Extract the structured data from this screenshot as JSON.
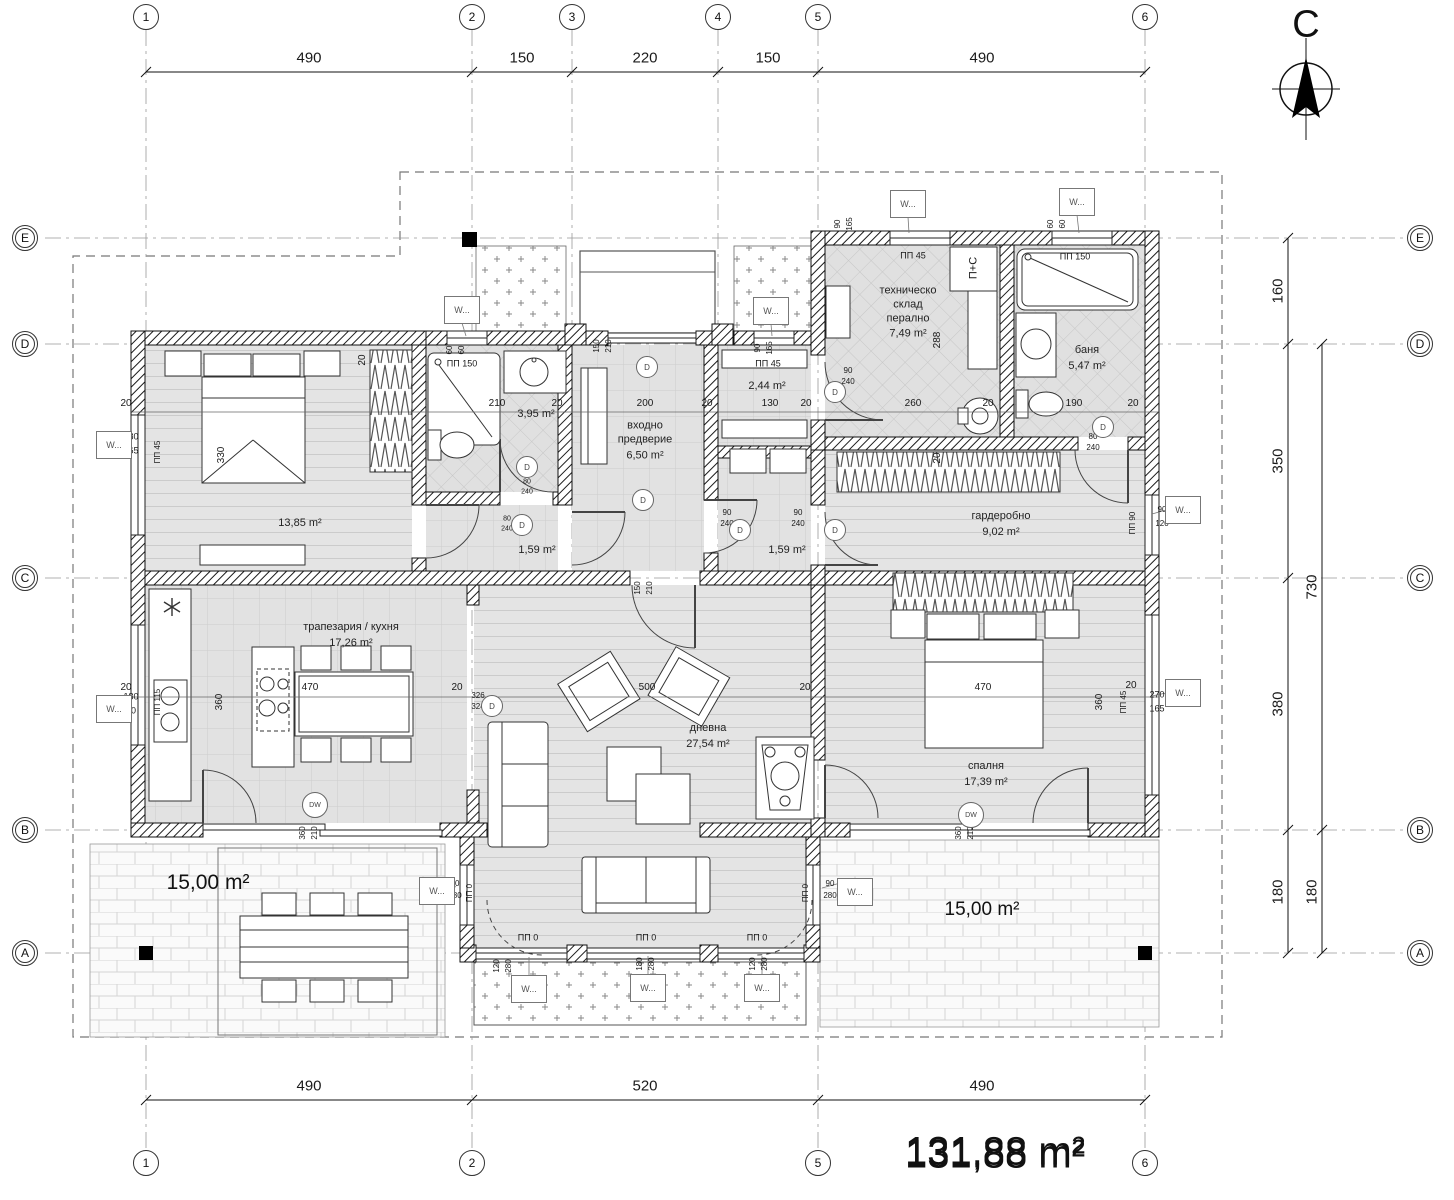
{
  "meta": {
    "north_label": "С",
    "total_area": "131,88 m²"
  },
  "grid": {
    "cols": [
      {
        "label": "1",
        "x": 146,
        "bottom": true
      },
      {
        "label": "2",
        "x": 472,
        "bottom": true
      },
      {
        "label": "3",
        "x": 572,
        "bottom": false
      },
      {
        "label": "4",
        "x": 718,
        "bottom": false
      },
      {
        "label": "5",
        "x": 818,
        "bottom": true
      },
      {
        "label": "6",
        "x": 1145,
        "bottom": true
      }
    ],
    "rows": [
      {
        "label": "E",
        "y": 238
      },
      {
        "label": "D",
        "y": 344
      },
      {
        "label": "C",
        "y": 578
      },
      {
        "label": "B",
        "y": 830
      },
      {
        "label": "A",
        "y": 953
      }
    ]
  },
  "dim_chains": {
    "top": [
      {
        "t": "490",
        "x": 309
      },
      {
        "t": "150",
        "x": 522
      },
      {
        "t": "220",
        "x": 645
      },
      {
        "t": "150",
        "x": 768
      },
      {
        "t": "490",
        "x": 982
      }
    ],
    "bottom": [
      {
        "t": "490",
        "x": 309
      },
      {
        "t": "520",
        "x": 645
      },
      {
        "t": "490",
        "x": 982
      }
    ],
    "right1": [
      {
        "t": "160",
        "y": 291
      },
      {
        "t": "350",
        "y": 461
      },
      {
        "t": "380",
        "y": 704
      },
      {
        "t": "180",
        "y": 892
      }
    ],
    "right2": [
      {
        "t": "730",
        "y": 587
      },
      {
        "t": "180",
        "y": 892
      }
    ]
  },
  "rooms": [
    {
      "name": "",
      "area": "13,85 m²",
      "x": 300,
      "y": 522
    },
    {
      "name": "",
      "area": "3,95 m²",
      "x": 536,
      "y": 413
    },
    {
      "name": "входно\nпредверие",
      "area": "6,50 m²",
      "x": 645,
      "y": 440
    },
    {
      "name": "",
      "area": "2,44 m²",
      "x": 767,
      "y": 385
    },
    {
      "name": "техническо\nсклад\nперално",
      "area": "7,49 m²",
      "x": 908,
      "y": 312
    },
    {
      "name": "баня",
      "area": "5,47 m²",
      "x": 1087,
      "y": 358
    },
    {
      "name": "гардеробно",
      "area": "9,02 m²",
      "x": 1001,
      "y": 524
    },
    {
      "name": "",
      "area": "1,59 m²",
      "x": 537,
      "y": 549
    },
    {
      "name": "",
      "area": "1,59 m²",
      "x": 787,
      "y": 549
    },
    {
      "name": "трапезария / кухня",
      "area": "17,26 m²",
      "x": 351,
      "y": 635
    },
    {
      "name": "дневна",
      "area": "27,54 m²",
      "x": 708,
      "y": 736
    },
    {
      "name": "спалня",
      "area": "17,39 m²",
      "x": 986,
      "y": 774
    }
  ],
  "area_labels": [
    {
      "text": "15,00 m²",
      "x": 208,
      "y": 883,
      "size": 21
    },
    {
      "text": "15,00 m²",
      "x": 982,
      "y": 910,
      "size": 19
    },
    {
      "text": "131,88 m²",
      "x": 995,
      "y": 1155,
      "size": 40
    }
  ],
  "window_tags": [
    {
      "label": "W...",
      "x": 114,
      "y": 445
    },
    {
      "label": "W...",
      "x": 114,
      "y": 709
    },
    {
      "label": "W...",
      "x": 462,
      "y": 310
    },
    {
      "label": "W...",
      "x": 771,
      "y": 311
    },
    {
      "label": "W...",
      "x": 908,
      "y": 204
    },
    {
      "label": "W...",
      "x": 1077,
      "y": 202
    },
    {
      "label": "W...",
      "x": 1183,
      "y": 510
    },
    {
      "label": "W...",
      "x": 1183,
      "y": 693
    },
    {
      "label": "W...",
      "x": 437,
      "y": 891
    },
    {
      "label": "W...",
      "x": 855,
      "y": 892
    },
    {
      "label": "W...",
      "x": 529,
      "y": 989
    },
    {
      "label": "W...",
      "x": 648,
      "y": 988
    },
    {
      "label": "W...",
      "x": 762,
      "y": 988
    }
  ],
  "door_tags": [
    {
      "label": "D",
      "x": 527,
      "y": 467
    },
    {
      "label": "D",
      "x": 522,
      "y": 525
    },
    {
      "label": "D",
      "x": 647,
      "y": 367
    },
    {
      "label": "D",
      "x": 643,
      "y": 500
    },
    {
      "label": "D",
      "x": 492,
      "y": 706
    },
    {
      "label": "D",
      "x": 740,
      "y": 530
    },
    {
      "label": "D",
      "x": 835,
      "y": 530
    },
    {
      "label": "D",
      "x": 835,
      "y": 392
    },
    {
      "label": "D",
      "x": 1103,
      "y": 427
    },
    {
      "label": "DW",
      "x": 971,
      "y": 815
    },
    {
      "label": "DW",
      "x": 315,
      "y": 805
    }
  ],
  "annotations": [
    {
      "t": "20",
      "x": 126,
      "y": 404
    },
    {
      "t": "210",
      "x": 497,
      "y": 404
    },
    {
      "t": "20",
      "x": 557,
      "y": 404
    },
    {
      "t": "200",
      "x": 645,
      "y": 404
    },
    {
      "t": "20",
      "x": 707,
      "y": 404
    },
    {
      "t": "130",
      "x": 770,
      "y": 404
    },
    {
      "t": "20",
      "x": 806,
      "y": 404
    },
    {
      "t": "260",
      "x": 913,
      "y": 404
    },
    {
      "t": "20",
      "x": 988,
      "y": 404
    },
    {
      "t": "190",
      "x": 1074,
      "y": 404
    },
    {
      "t": "490",
      "x": 1103,
      "y": 428,
      "r": -90
    },
    {
      "t": "20",
      "x": 1133,
      "y": 404
    },
    {
      "t": "330",
      "x": 222,
      "y": 455,
      "r": -90
    },
    {
      "t": "20",
      "x": 363,
      "y": 360,
      "r": -90
    },
    {
      "t": "180",
      "x": 131,
      "y": 437,
      "s": 9
    },
    {
      "t": "165",
      "x": 131,
      "y": 451,
      "s": 9
    },
    {
      "t": "ПП 45",
      "x": 158,
      "y": 452,
      "r": -90,
      "s": 8
    },
    {
      "t": "180",
      "x": 131,
      "y": 697,
      "s": 9
    },
    {
      "t": "40",
      "x": 131,
      "y": 711,
      "s": 9
    },
    {
      "t": "ПП 115",
      "x": 158,
      "y": 702,
      "r": -90,
      "s": 8
    },
    {
      "t": "20",
      "x": 126,
      "y": 688
    },
    {
      "t": "360",
      "x": 220,
      "y": 702,
      "r": -90
    },
    {
      "t": "470",
      "x": 310,
      "y": 688
    },
    {
      "t": "20",
      "x": 457,
      "y": 688
    },
    {
      "t": "326",
      "x": 478,
      "y": 696,
      "s": 8
    },
    {
      "t": "324",
      "x": 478,
      "y": 707,
      "s": 8
    },
    {
      "t": "500",
      "x": 647,
      "y": 688
    },
    {
      "t": "20",
      "x": 805,
      "y": 688
    },
    {
      "t": "470",
      "x": 983,
      "y": 688
    },
    {
      "t": "360",
      "x": 1100,
      "y": 702,
      "r": -90
    },
    {
      "t": "20",
      "x": 1131,
      "y": 686
    },
    {
      "t": "270",
      "x": 1157,
      "y": 695,
      "s": 9
    },
    {
      "t": "165",
      "x": 1157,
      "y": 709,
      "s": 9
    },
    {
      "t": "ПП 45",
      "x": 1124,
      "y": 702,
      "r": -90,
      "s": 8
    },
    {
      "t": "288",
      "x": 938,
      "y": 340,
      "r": -90
    },
    {
      "t": "20",
      "x": 938,
      "y": 458,
      "r": -90
    },
    {
      "t": "90",
      "x": 838,
      "y": 224,
      "r": -90,
      "s": 8
    },
    {
      "t": "165",
      "x": 850,
      "y": 224,
      "r": -90,
      "s": 8
    },
    {
      "t": "ПП 45",
      "x": 913,
      "y": 256,
      "s": 9
    },
    {
      "t": "60",
      "x": 1051,
      "y": 224,
      "r": -90,
      "s": 8
    },
    {
      "t": "60",
      "x": 1063,
      "y": 224,
      "r": -90,
      "s": 8
    },
    {
      "t": "ПП 150",
      "x": 1075,
      "y": 257,
      "s": 9
    },
    {
      "t": "60",
      "x": 450,
      "y": 350,
      "r": -90,
      "s": 8
    },
    {
      "t": "60",
      "x": 462,
      "y": 350,
      "r": -90,
      "s": 8
    },
    {
      "t": "90",
      "x": 758,
      "y": 348,
      "r": -90,
      "s": 8
    },
    {
      "t": "165",
      "x": 770,
      "y": 348,
      "r": -90,
      "s": 8
    },
    {
      "t": "ПП 45",
      "x": 768,
      "y": 364,
      "s": 9
    },
    {
      "t": "ПП 150",
      "x": 462,
      "y": 364,
      "s": 9
    },
    {
      "t": "150",
      "x": 597,
      "y": 346,
      "r": -90,
      "s": 8
    },
    {
      "t": "210",
      "x": 609,
      "y": 346,
      "r": -90,
      "s": 8
    },
    {
      "t": "150",
      "x": 638,
      "y": 588,
      "r": -90,
      "s": 8
    },
    {
      "t": "210",
      "x": 650,
      "y": 588,
      "r": -90,
      "s": 8
    },
    {
      "t": "360",
      "x": 303,
      "y": 833,
      "r": -90,
      "s": 8
    },
    {
      "t": "210",
      "x": 315,
      "y": 833,
      "r": -90,
      "s": 8
    },
    {
      "t": "360",
      "x": 959,
      "y": 833,
      "r": -90,
      "s": 8
    },
    {
      "t": "210",
      "x": 971,
      "y": 833,
      "r": -90,
      "s": 8
    },
    {
      "t": "80",
      "x": 507,
      "y": 519,
      "s": 7
    },
    {
      "t": "240",
      "x": 507,
      "y": 529,
      "s": 7
    },
    {
      "t": "80",
      "x": 527,
      "y": 482,
      "s": 7
    },
    {
      "t": "240",
      "x": 527,
      "y": 492,
      "s": 7
    },
    {
      "t": "90",
      "x": 727,
      "y": 513,
      "s": 8
    },
    {
      "t": "240",
      "x": 727,
      "y": 524,
      "s": 8
    },
    {
      "t": "90",
      "x": 798,
      "y": 513,
      "s": 8
    },
    {
      "t": "240",
      "x": 798,
      "y": 524,
      "s": 8
    },
    {
      "t": "90",
      "x": 848,
      "y": 371,
      "s": 8
    },
    {
      "t": "240",
      "x": 848,
      "y": 382,
      "s": 8
    },
    {
      "t": "80",
      "x": 1093,
      "y": 437,
      "s": 8
    },
    {
      "t": "240",
      "x": 1093,
      "y": 448,
      "s": 8
    },
    {
      "t": "90",
      "x": 455,
      "y": 884,
      "s": 8
    },
    {
      "t": "280",
      "x": 455,
      "y": 896,
      "s": 8
    },
    {
      "t": "ПП 0",
      "x": 470,
      "y": 893,
      "r": -90,
      "s": 8
    },
    {
      "t": "90",
      "x": 830,
      "y": 884,
      "s": 8
    },
    {
      "t": "280",
      "x": 830,
      "y": 896,
      "s": 8
    },
    {
      "t": "ПП 0",
      "x": 806,
      "y": 893,
      "r": -90,
      "s": 8
    },
    {
      "t": "120",
      "x": 497,
      "y": 966,
      "r": -90,
      "s": 8
    },
    {
      "t": "280",
      "x": 509,
      "y": 966,
      "r": -90,
      "s": 8
    },
    {
      "t": "180",
      "x": 640,
      "y": 964,
      "r": -90,
      "s": 8
    },
    {
      "t": "280",
      "x": 652,
      "y": 964,
      "r": -90,
      "s": 8
    },
    {
      "t": "120",
      "x": 753,
      "y": 964,
      "r": -90,
      "s": 8
    },
    {
      "t": "280",
      "x": 765,
      "y": 964,
      "r": -90,
      "s": 8
    },
    {
      "t": "ПП 0",
      "x": 528,
      "y": 938,
      "s": 9
    },
    {
      "t": "ПП 0",
      "x": 646,
      "y": 938,
      "s": 9
    },
    {
      "t": "ПП 0",
      "x": 757,
      "y": 938,
      "s": 9
    },
    {
      "t": "90",
      "x": 1162,
      "y": 510,
      "s": 8
    },
    {
      "t": "120",
      "x": 1162,
      "y": 524,
      "s": 8
    },
    {
      "t": "ПП 90",
      "x": 1133,
      "y": 523,
      "r": -90,
      "s": 8
    },
    {
      "t": "П+С",
      "x": 974,
      "y": 268,
      "r": -90,
      "s": 11
    }
  ]
}
